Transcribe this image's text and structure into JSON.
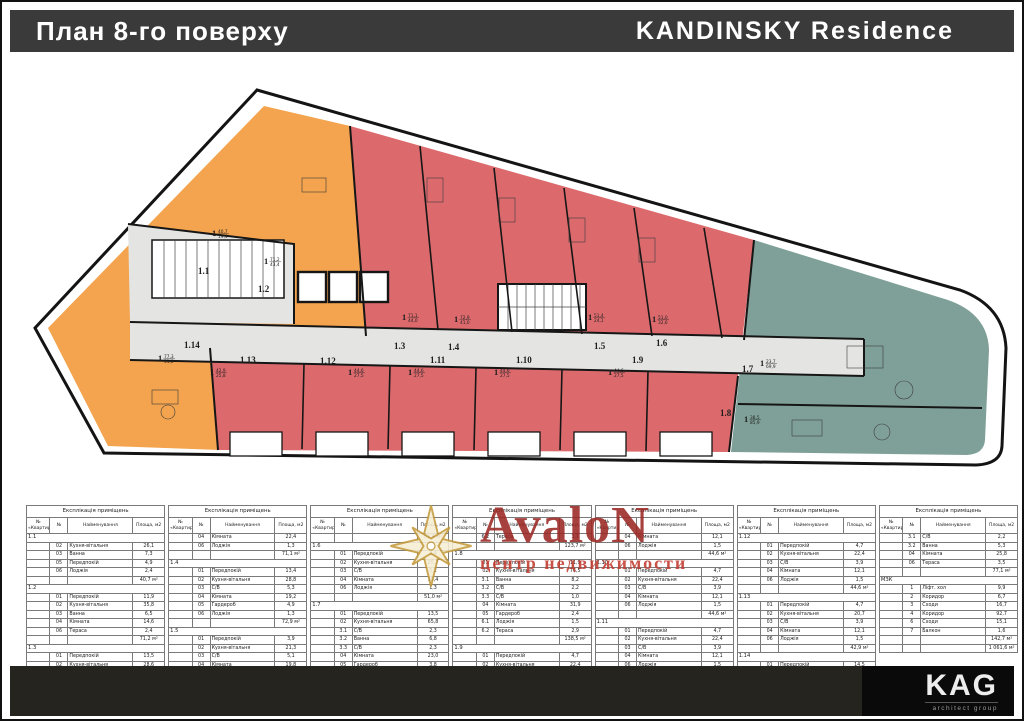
{
  "header": {
    "title": "План 8-го поверху",
    "project": "KANDINSKY  Residence"
  },
  "plan": {
    "colors": {
      "orange": "#F4A44E",
      "red": "#DC6A6D",
      "teal": "#7FA098",
      "corridor": "#E4E4E2",
      "wall": "#161616"
    },
    "units": [
      {
        "id": "1.1",
        "type_digit": "1",
        "area_top": "40,7",
        "area_bottom": "19,4",
        "zone": "orange"
      },
      {
        "id": "1.2",
        "type_digit": "1",
        "area_top": "71,2",
        "area_bottom": "43,4",
        "zone": "orange"
      },
      {
        "id": "1.3",
        "type_digit": "1",
        "area_top": "71,1",
        "area_bottom": "44,0",
        "zone": "red"
      },
      {
        "id": "1.4",
        "type_digit": "1",
        "area_top": "72,9",
        "area_bottom": "41,0",
        "zone": "red"
      },
      {
        "id": "1.5",
        "type_digit": "1",
        "area_top": "51,4",
        "area_bottom": "24,1",
        "zone": "red"
      },
      {
        "id": "1.6",
        "type_digit": "1",
        "area_top": "51,0",
        "area_bottom": "32,6",
        "zone": "red"
      },
      {
        "id": "1.7",
        "type_digit": "1",
        "area_top": "23,7",
        "area_bottom": "69,9",
        "zone": "teal"
      },
      {
        "id": "1.8",
        "type_digit": "1",
        "area_top": "38,5",
        "area_bottom": "85,9",
        "zone": "teal"
      },
      {
        "id": "1.9",
        "type_digit": "1",
        "area_top": "44,6",
        "area_bottom": "27,5",
        "zone": "red"
      },
      {
        "id": "1.10",
        "type_digit": "1",
        "area_top": "44,6",
        "area_bottom": "27,5",
        "zone": "red"
      },
      {
        "id": "1.11",
        "type_digit": "1",
        "area_top": "44,6",
        "area_bottom": "27,5",
        "zone": "red"
      },
      {
        "id": "1.12",
        "type_digit": "1",
        "area_top": "44,6",
        "area_bottom": "27,5",
        "zone": "red"
      },
      {
        "id": "1.13",
        "type_digit": "1",
        "area_top": "42,9",
        "area_bottom": "25,8",
        "zone": "red"
      },
      {
        "id": "1.14",
        "type_digit": "1",
        "area_top": "77,3",
        "area_bottom": "51,8",
        "zone": "orange"
      }
    ]
  },
  "explication": {
    "title": "Експлікація приміщень",
    "col_apt": "№ «Квартири»",
    "col_num": "№",
    "col_name": "Найменування",
    "col_area": "Площа, м2"
  },
  "tables": [
    {
      "groups": [
        {
          "apt": "1.1",
          "rows": [
            [
              "02",
              "Кухня-вітальня",
              "26,1"
            ],
            [
              "03",
              "Ванна",
              "7,3"
            ],
            [
              "05",
              "Передпокій",
              "4,9"
            ],
            [
              "06",
              "Лоджія",
              "2,4"
            ]
          ],
          "total": "40,7 м²"
        },
        {
          "apt": "1.2",
          "rows": [
            [
              "01",
              "Передпокій",
              "11,9"
            ],
            [
              "02",
              "Кухня-вітальня",
              "35,8"
            ],
            [
              "03",
              "Ванна",
              "6,5"
            ],
            [
              "04",
              "Кімната",
              "14,6"
            ],
            [
              "06",
              "Тераса",
              "2,4"
            ]
          ],
          "total": "71,2 м²"
        },
        {
          "apt": "1.3",
          "rows": [
            [
              "01",
              "Передпокій",
              "13,5"
            ],
            [
              "02",
              "Кухня-вітальня",
              "28,6"
            ],
            [
              "03",
              "С/В",
              "5,3"
            ]
          ]
        }
      ]
    },
    {
      "groups": [
        {
          "rows": [
            [
              "04",
              "Кімната",
              "22,4"
            ],
            [
              "06",
              "Лоджія",
              "1,3"
            ]
          ],
          "total": "71,1 м²"
        },
        {
          "apt": "1.4",
          "rows": [
            [
              "01",
              "Передпокій",
              "13,4"
            ],
            [
              "02",
              "Кухня-вітальня",
              "28,8"
            ],
            [
              "03",
              "С/В",
              "5,3"
            ],
            [
              "04",
              "Кімната",
              "19,2"
            ],
            [
              "05",
              "Гардероб",
              "4,9"
            ],
            [
              "06",
              "Лоджія",
              "1,3"
            ]
          ],
          "total": "72,9 м²"
        },
        {
          "apt": "1.5",
          "rows": [
            [
              "01",
              "Передпокій",
              "3,9"
            ],
            [
              "02",
              "Кухня-вітальня",
              "21,3"
            ],
            [
              "03",
              "С/В",
              "5,1"
            ],
            [
              "04",
              "Кімната",
              "19,8"
            ],
            [
              "06",
              "Лоджія",
              "1,3"
            ]
          ]
        }
      ]
    },
    {
      "groups": [
        {
          "rows": [],
          "total": "51,4 м²"
        },
        {
          "apt": "1.6",
          "rows": [
            [
              "01",
              "Передпокій",
              "3,4"
            ],
            [
              "02",
              "Кухня-вітальня",
              "25,7"
            ],
            [
              "03",
              "С/В",
              "5,2"
            ],
            [
              "04",
              "Кімната",
              "15,4"
            ],
            [
              "06",
              "Лоджія",
              "1,3"
            ]
          ],
          "total": "51,0 м²"
        },
        {
          "apt": "1.7",
          "rows": [
            [
              "01",
              "Передпокій",
              "13,5"
            ],
            [
              "02",
              "Кухня-вітальня",
              "65,8"
            ],
            [
              "3.1",
              "С/В",
              "2,3"
            ],
            [
              "3.2",
              "Ванна",
              "6,8"
            ],
            [
              "3.3",
              "С/В",
              "2,3"
            ],
            [
              "04",
              "Кімната",
              "23,0"
            ],
            [
              "05",
              "Гардероб",
              "3,8"
            ],
            [
              "6.1",
              "Лоджія",
              "3,1"
            ]
          ]
        }
      ]
    },
    {
      "groups": [
        {
          "rows": [
            [
              "6.2",
              "Тераса",
              "3,1"
            ]
          ],
          "total": "123,7 м²"
        },
        {
          "apt": "1.8",
          "rows": [
            [
              "01",
              "Передпокій",
              "11,9"
            ],
            [
              "02",
              "Кухня-вітальня",
              "76,5"
            ],
            [
              "3.1",
              "Ванна",
              "8,2"
            ],
            [
              "3.2",
              "С/В",
              "2,2"
            ],
            [
              "3.3",
              "С/В",
              "1,0"
            ],
            [
              "04",
              "Кімната",
              "31,9"
            ],
            [
              "05",
              "Гардероб",
              "2,4"
            ],
            [
              "6.1",
              "Лоджія",
              "1,5"
            ],
            [
              "6.2",
              "Тераса",
              "2,9"
            ]
          ],
          "total": "138,5 м²"
        },
        {
          "apt": "1.9",
          "rows": [
            [
              "01",
              "Передпокій",
              "4,7"
            ],
            [
              "02",
              "Кухня-вітальня",
              "22,4"
            ],
            [
              "03",
              "С/В",
              "3,9"
            ]
          ]
        }
      ]
    },
    {
      "groups": [
        {
          "rows": [
            [
              "04",
              "Кімната",
              "12,1"
            ],
            [
              "06",
              "Лоджія",
              "1,5"
            ]
          ],
          "total": "44,6 м²"
        },
        {
          "apt": "1.10",
          "rows": [
            [
              "01",
              "Передпокій",
              "4,7"
            ],
            [
              "02",
              "Кухня-вітальня",
              "22,4"
            ],
            [
              "03",
              "С/В",
              "3,9"
            ],
            [
              "04",
              "Кімната",
              "12,1"
            ],
            [
              "06",
              "Лоджія",
              "1,5"
            ]
          ],
          "total": "44,6 м²"
        },
        {
          "apt": "1.11",
          "rows": [
            [
              "01",
              "Передпокій",
              "4,7"
            ],
            [
              "02",
              "Кухня-вітальня",
              "22,4"
            ],
            [
              "03",
              "С/В",
              "3,9"
            ],
            [
              "04",
              "Кімната",
              "12,1"
            ],
            [
              "06",
              "Лоджія",
              "1,5"
            ]
          ],
          "total": "44,6 м²"
        }
      ]
    },
    {
      "groups": [
        {
          "apt": "1.12",
          "rows": [
            [
              "01",
              "Передпокій",
              "4,7"
            ],
            [
              "02",
              "Кухня-вітальня",
              "22,4"
            ],
            [
              "03",
              "С/В",
              "3,9"
            ],
            [
              "04",
              "Кімната",
              "12,1"
            ],
            [
              "06",
              "Лоджія",
              "1,5"
            ]
          ],
          "total": "44,6 м²"
        },
        {
          "apt": "1.13",
          "rows": [
            [
              "01",
              "Передпокій",
              "4,7"
            ],
            [
              "02",
              "Кухня-вітальня",
              "20,7"
            ],
            [
              "03",
              "С/В",
              "3,9"
            ],
            [
              "04",
              "Кімната",
              "12,1"
            ],
            [
              "06",
              "Лоджія",
              "1,5"
            ]
          ],
          "total": "42,9 м²"
        },
        {
          "apt": "1.14",
          "rows": [
            [
              "01",
              "Передпокій",
              "14,5"
            ],
            [
              "02",
              "Кухня-вітальня",
              "25,8"
            ]
          ]
        }
      ]
    },
    {
      "groups": [
        {
          "rows": [
            [
              "3.1",
              "С/В",
              "2,2"
            ],
            [
              "3.2",
              "Ванна",
              "5,3"
            ],
            [
              "04",
              "Кімната",
              "25,8"
            ],
            [
              "06",
              "Тераса",
              "3,5"
            ]
          ],
          "total": "77,1 м²"
        },
        {
          "apt": "МЗК",
          "rows": [
            [
              "1",
              "Ліфт. хол",
              "9,9"
            ],
            [
              "2",
              "Коридор",
              "6,7"
            ],
            [
              "3",
              "Сходи",
              "16,7"
            ],
            [
              "4",
              "Коридор",
              "92,7"
            ],
            [
              "6",
              "Сходи",
              "15,1"
            ],
            [
              "7",
              "Балкон",
              "1,6"
            ]
          ],
          "total": "142,7 м²",
          "grand": "1 061,6 м²"
        }
      ]
    }
  ],
  "watermark": {
    "name": "AvaloN",
    "subtitle": "центр недвижимости"
  },
  "footer": {
    "logo": "KAG",
    "logo_subtitle": "architect group"
  }
}
